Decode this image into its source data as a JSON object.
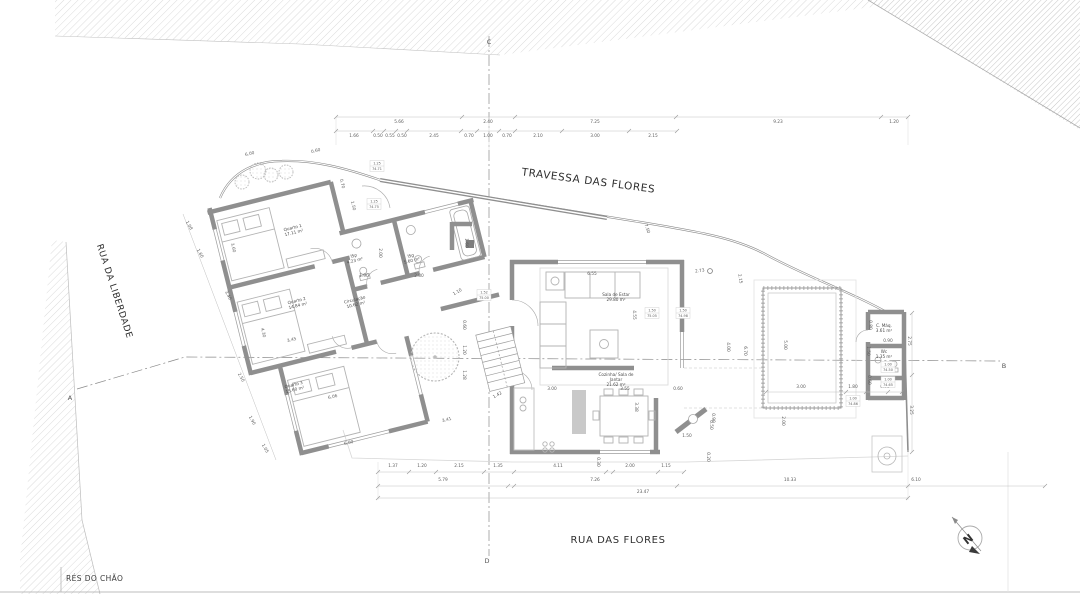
{
  "sheet": {
    "floor_label": "RÉS DO CHÃO"
  },
  "streets": {
    "travessa": "TRAVESSA DAS FLORES",
    "rua_flores": "RUA DAS FLORES",
    "rua_liberdade": "RUA DA LIBERDADE"
  },
  "section_markers": {
    "a": "A",
    "b": "B",
    "c": "C",
    "d": "D"
  },
  "north": {
    "label": "N"
  },
  "rooms": [
    {
      "name": "Quarto 1",
      "area": "17.11 m²"
    },
    {
      "name": "Quarto 2",
      "area": "14.84 m²"
    },
    {
      "name": "Quarto 3",
      "area": "15.60 m²"
    },
    {
      "name": "Circulação",
      "area": "10.62 m²"
    },
    {
      "name": "ISp",
      "area": "4.23 m²"
    },
    {
      "name": "ISg",
      "area": "5.60 m²"
    },
    {
      "name": "Sala de Estar",
      "area": "29.80 m²"
    },
    {
      "name": "Cozinha/ Sala de\nJantar",
      "area": "21.62 m²"
    },
    {
      "name": "C. Máq.",
      "area": "3.61 m²"
    },
    {
      "name": "Wc",
      "area": "1.35 m²"
    }
  ],
  "dim_labels": [
    "5.66",
    "2.40",
    "7.25",
    "9.23",
    "1.20",
    "1.66",
    "0.50",
    "0.55",
    "0.50",
    "2.45",
    "0.70",
    "1.00",
    "0.70",
    "2.10",
    "3.00",
    "2.15",
    "6.00",
    "0.60",
    "0.70",
    "1.50",
    "1.08",
    "1.60",
    "3.40",
    "2.50",
    "1.90",
    "1.05",
    "3.60",
    "3.45",
    "4.30",
    "6.06",
    "6.00",
    "1.10",
    "2.00",
    "1.90",
    "2.80",
    "1.60",
    "0.60",
    "1.20",
    "1.28",
    "1.42",
    "3.41",
    "6.55",
    "4.55",
    "2.73",
    "2.15",
    "7.50",
    "4.00",
    "6.70",
    "3.00",
    "3.55",
    "0.60",
    "3.38",
    "1.50",
    "0.50",
    "0.90",
    "4.11",
    "2.00",
    "1.15",
    "0.30",
    "0.20",
    "1.37",
    "1.20",
    "2.15",
    "1.35",
    "5.79",
    "7.26",
    "10.33",
    "6.10",
    "23.47",
    "5.00",
    "3.00",
    "1.80",
    "0.95",
    "0.60",
    "2.75",
    "3.25",
    "0.80",
    "1.50",
    "0.70",
    "2.00",
    "0.90"
  ],
  "window_tags": [
    {
      "sill": "1.25",
      "level": "74.71"
    },
    {
      "sill": "1.25",
      "level": "74.75"
    },
    {
      "sill": "1.50",
      "level": "75.05"
    },
    {
      "sill": "1.50",
      "level": "74.98"
    },
    {
      "sill": "1.52",
      "level": "75.00"
    },
    {
      "sill": "1.00",
      "level": "74.50"
    },
    {
      "sill": "1.00",
      "level": "74.65"
    },
    {
      "sill": "1.00",
      "level": "74.86"
    }
  ]
}
